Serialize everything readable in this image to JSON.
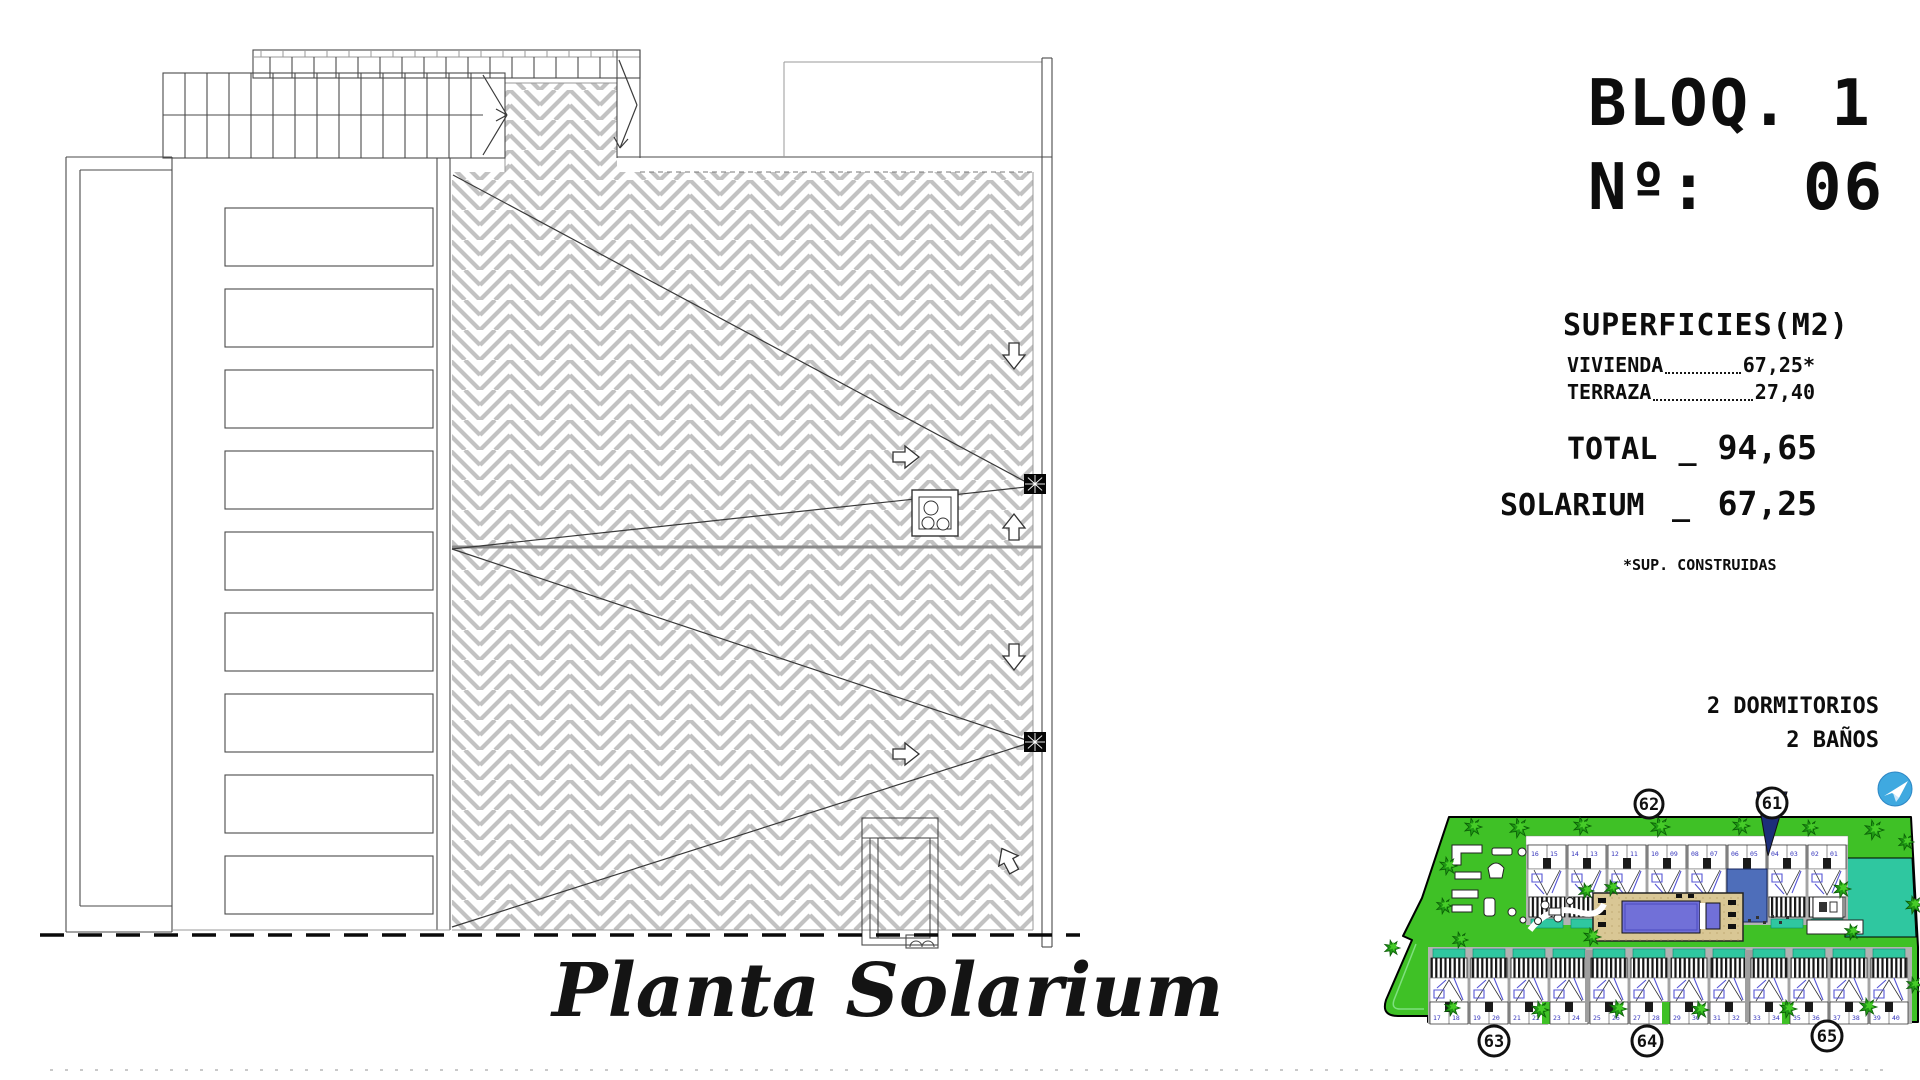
{
  "title": {
    "line1": "BLOQ. 1",
    "line2_label": "Nº:",
    "line2_value": "06"
  },
  "surfaces": {
    "heading": "SUPERFICIES(M2)",
    "rows": [
      {
        "label": "VIVIENDA",
        "value": "67,25*"
      },
      {
        "label": "TERRAZA",
        "value": "27,40"
      }
    ],
    "total": {
      "label": "TOTAL",
      "sep": "_",
      "value": "94,65"
    },
    "solarium": {
      "label": "SOLARIUM",
      "sep": "_",
      "value": "67,25"
    },
    "footnote": "*SUP. CONSTRUIDAS"
  },
  "features": {
    "bedrooms": "2 DORMITORIOS",
    "bathrooms": "2 BAÑOS"
  },
  "plan": {
    "caption": "Planta Solarium"
  },
  "site": {
    "markers": [
      {
        "label": "62"
      },
      {
        "label": "61",
        "flag": true
      },
      {
        "label": "63"
      },
      {
        "label": "64"
      },
      {
        "label": "65"
      }
    ],
    "highlight_index": 5,
    "highlighted_unit": "06",
    "top_row_numbers": [
      "16 15",
      "14 13",
      "12 11",
      "10 09",
      "08 07",
      "06 05",
      "04 03",
      "02 01"
    ],
    "bottom_row_numbers": [
      "17 18",
      "19 20",
      "21 22",
      "23 24",
      "25 26",
      "27 28",
      "29 30",
      "31 32",
      "33 34",
      "35 36",
      "37 38",
      "39 40"
    ]
  },
  "colors": {
    "lawn": "#3fc126",
    "tree_dark": "#1f9914",
    "tree_light": "#46cc28",
    "teal": "#2fc7a0",
    "deck": "#d9c795",
    "pool": "#7170d8",
    "unit_blue": "#4e6eba",
    "flag_navy": "#1d2e7a",
    "logo_blue": "#3fa9e0",
    "gray": "#b3b3b3",
    "furn": "#5656d6",
    "hatch_joint": "#c2c2c2"
  }
}
